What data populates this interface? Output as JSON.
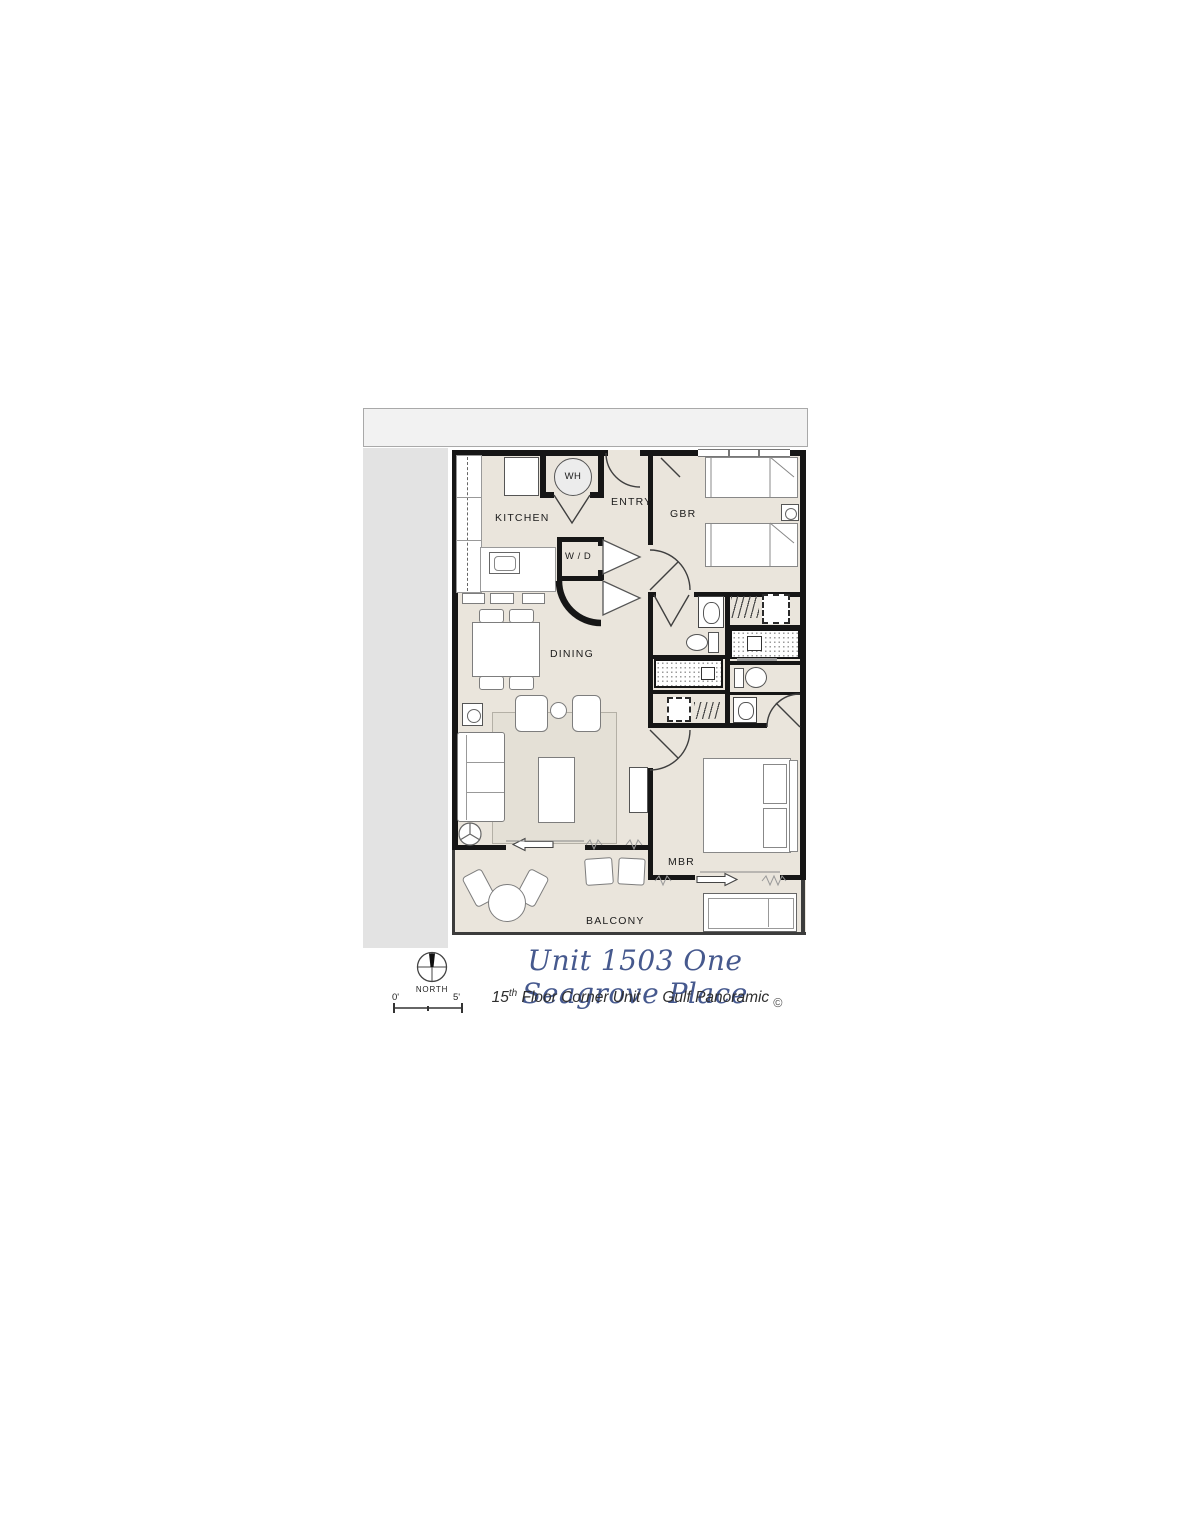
{
  "plan": {
    "labels": {
      "kitchen": "KITCHEN",
      "entry": "ENTRY",
      "gbr": "GBR",
      "wd": "W / D",
      "wh": "WH",
      "dining": "DINING",
      "mbr": "MBR",
      "balcony": "BALCONY"
    }
  },
  "title_block": {
    "north": "NORTH",
    "scale_left": "0'",
    "scale_right": "5'",
    "title": "Unit 1503 One Seagrove Place",
    "floor_num": "15",
    "floor_sup": "th",
    "floor_rest": " Floor Corner Unit",
    "view": "Gulf Panoramic",
    "copyright": "©"
  },
  "colors": {
    "title_blue": "#46598E",
    "floor_beige": "#EAE5DC",
    "wall_black": "#161616",
    "band_gray": "#E3E3E3"
  }
}
